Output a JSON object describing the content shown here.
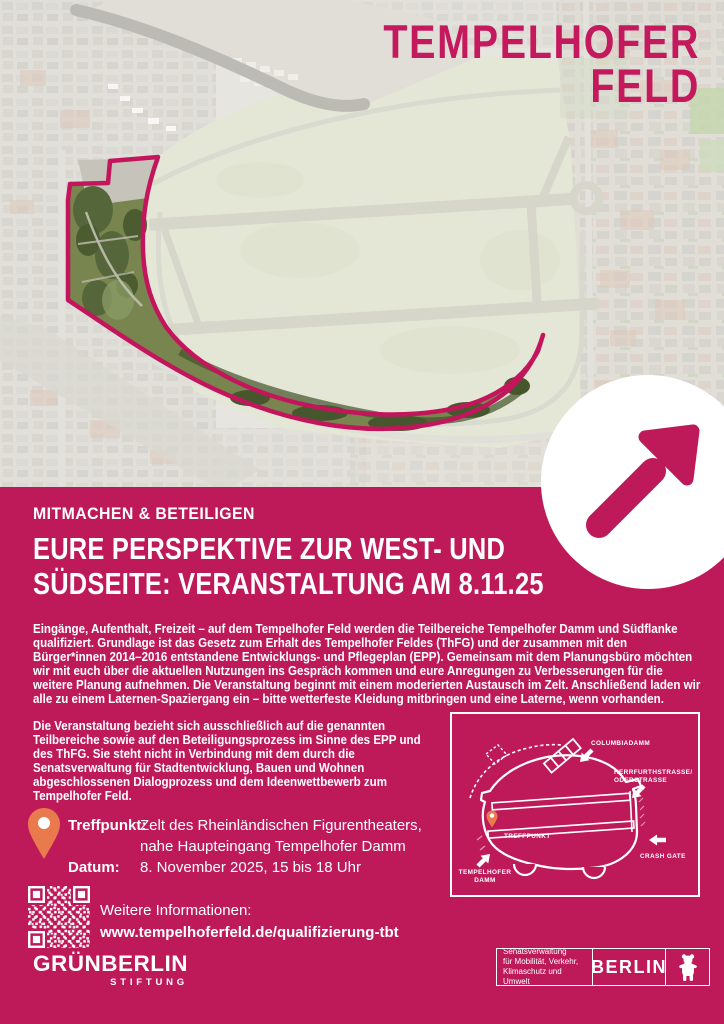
{
  "colors": {
    "magenta": "#BE1A5A",
    "brand_magenta": "#C4195C",
    "pin_orange": "#E87A4E",
    "white": "#FFFFFF"
  },
  "brand": {
    "line1": "TEMPELHOFER",
    "line2": "FELD"
  },
  "eyebrow": "MITMACHEN & BETEILIGEN",
  "headline": {
    "line1": "EURE PERSPEKTIVE ZUR WEST- UND",
    "line2": "SÜDSEITE: VERANSTALTUNG AM 8.11.25"
  },
  "body": {
    "paragraph1": "Eingänge, Aufenthalt, Freizeit – auf dem Tempelhofer Feld werden die Teilbereiche Tempelhofer Damm und Südflanke qualifiziert. Grundlage ist das Gesetz zum Erhalt des Tempelhofer Feldes (ThFG) und der zusammen mit den Bürger*innen 2014–2016 entstandene Entwicklungs- und Pflegeplan (EPP). Gemeinsam mit dem Planungsbüro möchten wir mit euch über die aktuellen Nutzungen ins Gespräch kommen und eure Anregungen zu Verbesserungen für die weitere Planung aufnehmen. Die Veranstaltung beginnt mit einem moderierten Austausch im Zelt. Anschließend laden wir alle zu einem Laternen-Spaziergang ein – bitte wetterfeste Kleidung mitbringen und eine Laterne, wenn vorhanden.",
    "paragraph2": "Die Veranstaltung bezieht sich ausschließlich auf die genannten Teilbereiche sowie auf den Beteiligungsprozess im Sinne des EPP und des ThFG. Sie steht nicht in Verbindung mit dem durch die Senatsverwaltung für Stadtentwicklung, Bauen und Wohnen abgeschlossenen Dialogprozess und dem Ideenwettbewerb zum Tempelhofer Feld."
  },
  "details": {
    "treffpunkt_label": "Treffpunkt:",
    "treffpunkt_value_line1": "Zelt des Rheinländischen Figurentheaters,",
    "treffpunkt_value_line2": "nahe Haupteingang Tempelhofer Damm",
    "datum_label": "Datum:",
    "datum_value": "8. November 2025, 15 bis 18 Uhr"
  },
  "info": {
    "label": "Weitere Informationen:",
    "url": "www.tempelhoferfeld.de/qualifizierung-tbt"
  },
  "diagram": {
    "columbiadamm": "COLUMBIADAMM",
    "herrfurthstrasse_line1": "HERRFURTHSTRASSE/",
    "herrfurthstrasse_line2": "ODERSTRASSE",
    "treffpunkt": "TREFFPUNKT",
    "tempelhofer_damm_line1": "TEMPELHOFER",
    "tempelhofer_damm_line2": "DAMM",
    "crash_gate": "CRASH GATE"
  },
  "footer": {
    "gruenberlin": "GRÜNBERLIN",
    "stiftung": "STIFTUNG",
    "senat_line1": "Senatsverwaltung",
    "senat_line2": "für Mobilität, Verkehr,",
    "senat_line3": "Klimaschutz und Umwelt",
    "berlin": "BERLIN"
  }
}
